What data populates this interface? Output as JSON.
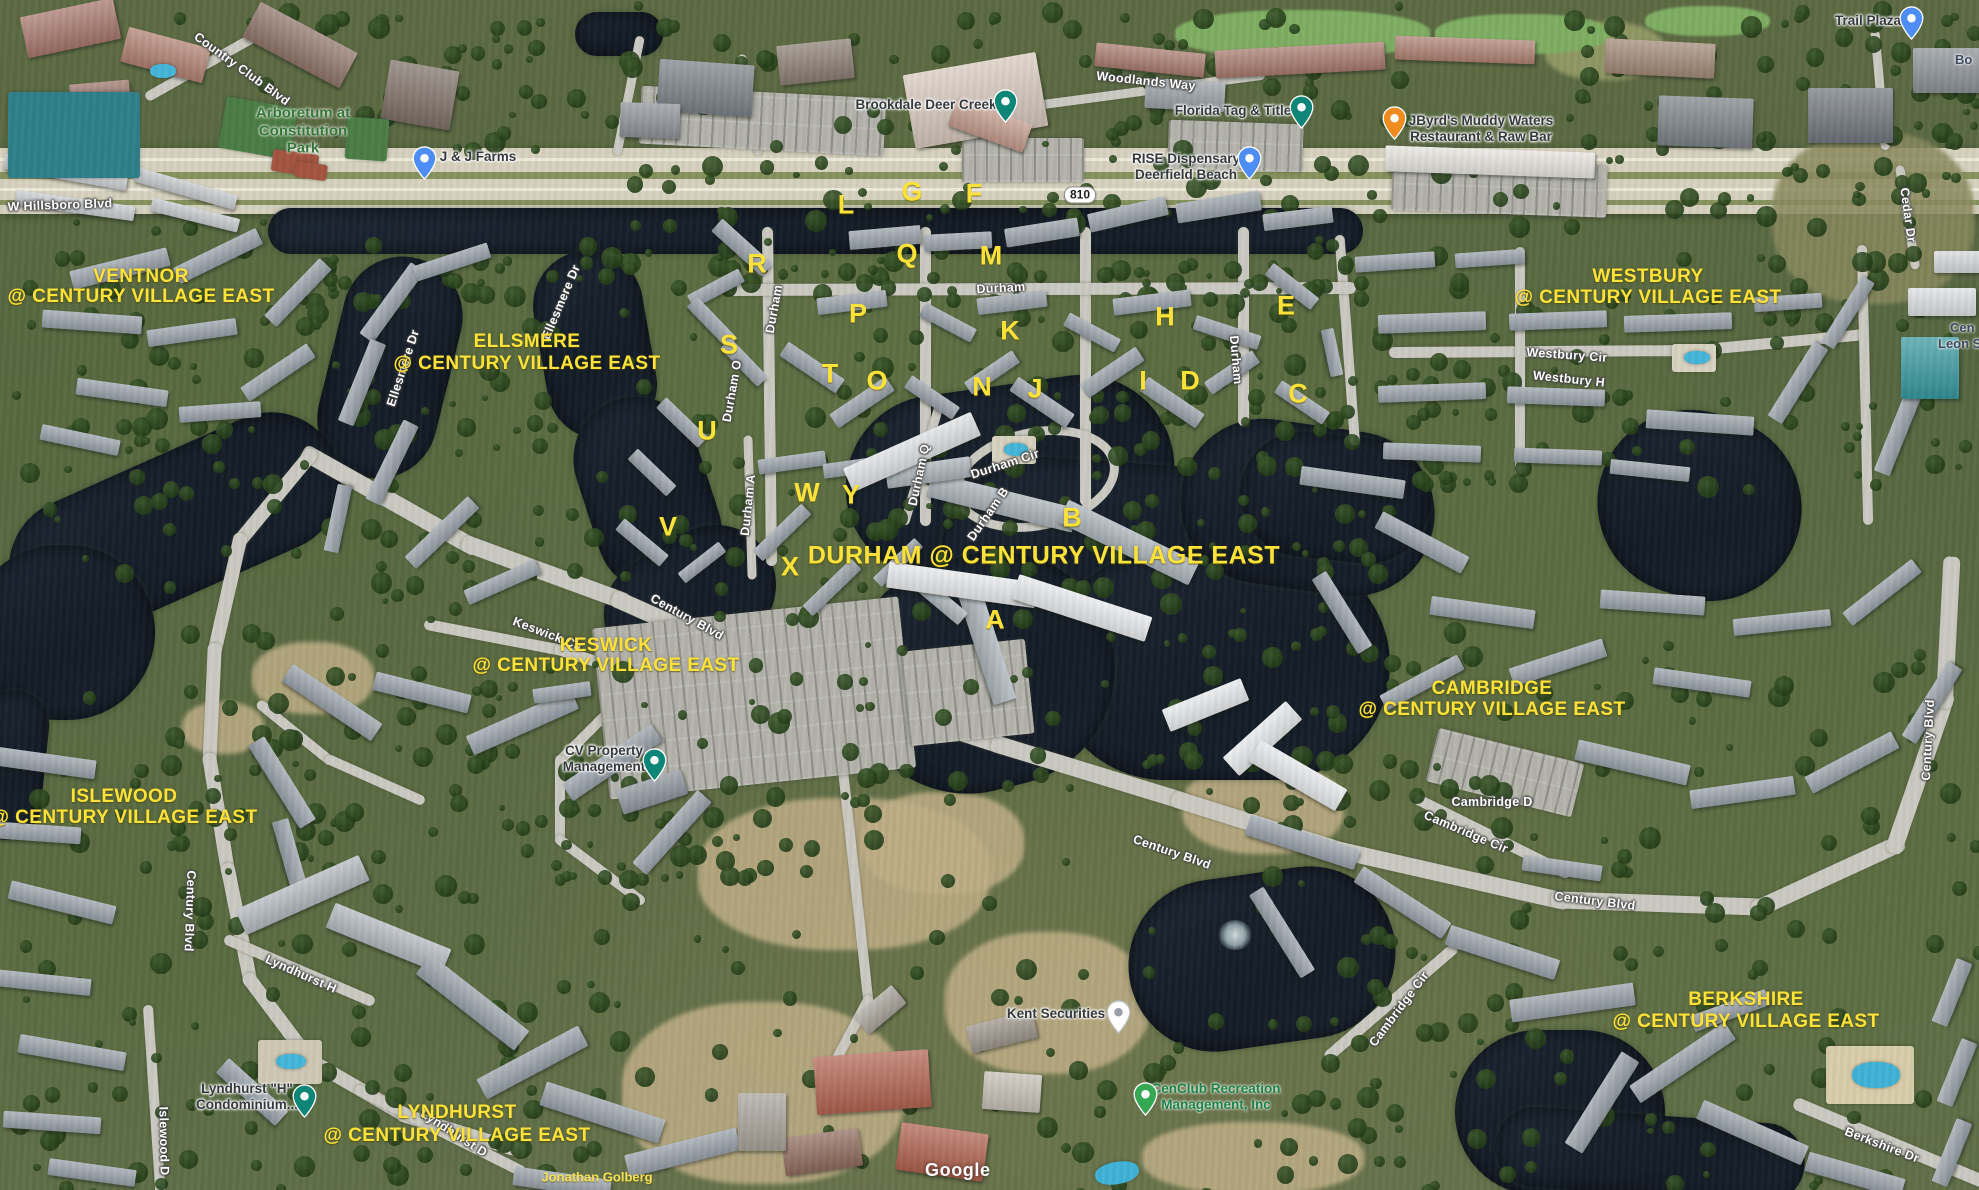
{
  "meta": {
    "app": "Google Maps satellite view",
    "area": "Century Village East, Deerfield Beach FL",
    "watermark": "Google"
  },
  "colors": {
    "overlay_yellow": "#fde23a",
    "road_label_white": "#ffffff",
    "poi_dark": "#35393d",
    "park_green": "#37773a",
    "rec_green": "#1b8246",
    "water": "#161e29",
    "pin_teal": "#0d8577",
    "pin_blue": "#4e8df5",
    "pin_orange": "#ef8b1f",
    "pin_green": "#34a853",
    "pin_white": "#ffffff"
  },
  "route_shield": {
    "text": "810",
    "x": 1080,
    "y": 195
  },
  "communities": [
    {
      "name": "VENTNOR",
      "tagline": "@ CENTURY VILLAGE EAST",
      "x": 141,
      "y": 277,
      "y2": 297,
      "big": false
    },
    {
      "name": "ELLSMERE",
      "tagline": "@ CENTURY VILLAGE EAST",
      "x": 527,
      "y": 342,
      "y2": 364,
      "big": false
    },
    {
      "name": "WESTBURY",
      "tagline": "@ CENTURY VILLAGE EAST",
      "x": 1648,
      "y": 277,
      "y2": 298,
      "big": false
    },
    {
      "name": "DURHAM @ CENTURY VILLAGE EAST",
      "tagline": "",
      "x": 1044,
      "y": 556,
      "y2": 0,
      "big": true
    },
    {
      "name": "KESWICK",
      "tagline": "@ CENTURY VILLAGE EAST",
      "x": 606,
      "y": 646,
      "y2": 666,
      "big": false
    },
    {
      "name": "ISLEWOOD",
      "tagline": "@ CENTURY VILLAGE EAST",
      "x": 124,
      "y": 797,
      "y2": 818,
      "big": false
    },
    {
      "name": "CAMBRIDGE",
      "tagline": "@ CENTURY VILLAGE EAST",
      "x": 1492,
      "y": 689,
      "y2": 710,
      "big": false
    },
    {
      "name": "BERKSHIRE",
      "tagline": "@ CENTURY VILLAGE EAST",
      "x": 1746,
      "y": 1000,
      "y2": 1022,
      "big": false
    },
    {
      "name": "LYNDHURST",
      "tagline": "@ CENTURY VILLAGE EAST",
      "x": 457,
      "y": 1113,
      "y2": 1136,
      "big": false
    }
  ],
  "building_letters": [
    {
      "t": "A",
      "x": 995,
      "y": 620
    },
    {
      "t": "B",
      "x": 1072,
      "y": 518
    },
    {
      "t": "C",
      "x": 1298,
      "y": 394
    },
    {
      "t": "D",
      "x": 1190,
      "y": 381
    },
    {
      "t": "E",
      "x": 1286,
      "y": 306
    },
    {
      "t": "F",
      "x": 974,
      "y": 194
    },
    {
      "t": "G",
      "x": 912,
      "y": 192
    },
    {
      "t": "H",
      "x": 1165,
      "y": 317
    },
    {
      "t": "I",
      "x": 1143,
      "y": 381
    },
    {
      "t": "J",
      "x": 1035,
      "y": 389
    },
    {
      "t": "K",
      "x": 1010,
      "y": 331
    },
    {
      "t": "L",
      "x": 846,
      "y": 205
    },
    {
      "t": "M",
      "x": 991,
      "y": 256
    },
    {
      "t": "N",
      "x": 982,
      "y": 387
    },
    {
      "t": "O",
      "x": 877,
      "y": 381
    },
    {
      "t": "P",
      "x": 858,
      "y": 314
    },
    {
      "t": "Q",
      "x": 907,
      "y": 254
    },
    {
      "t": "R",
      "x": 757,
      "y": 264
    },
    {
      "t": "S",
      "x": 729,
      "y": 345
    },
    {
      "t": "T",
      "x": 830,
      "y": 374
    },
    {
      "t": "U",
      "x": 707,
      "y": 431
    },
    {
      "t": "V",
      "x": 668,
      "y": 527
    },
    {
      "t": "W",
      "x": 807,
      "y": 493
    },
    {
      "t": "X",
      "x": 790,
      "y": 567
    },
    {
      "t": "Y",
      "x": 851,
      "y": 495
    }
  ],
  "road_labels": [
    {
      "t": "W Hillsboro Blvd",
      "x": 60,
      "y": 205,
      "r": -2
    },
    {
      "t": "Country Club Blvd",
      "x": 242,
      "y": 69,
      "r": 36
    },
    {
      "t": "Woodlands Way",
      "x": 1146,
      "y": 81,
      "r": 6
    },
    {
      "t": "Cedar Dr",
      "x": 1908,
      "y": 215,
      "r": 82
    },
    {
      "t": "Durham",
      "x": 1001,
      "y": 288,
      "r": -3
    },
    {
      "t": "Durham",
      "x": 774,
      "y": 309,
      "r": -80
    },
    {
      "t": "Durham",
      "x": 1236,
      "y": 360,
      "r": 85
    },
    {
      "t": "Durham A",
      "x": 748,
      "y": 505,
      "r": -84
    },
    {
      "t": "Durham O",
      "x": 732,
      "y": 391,
      "r": -80
    },
    {
      "t": "Durham Q",
      "x": 919,
      "y": 475,
      "r": -78
    },
    {
      "t": "Durham Cir",
      "x": 1005,
      "y": 464,
      "r": -18
    },
    {
      "t": "Durham B",
      "x": 988,
      "y": 514,
      "r": -55
    },
    {
      "t": "Ellesmere Dr",
      "x": 561,
      "y": 302,
      "r": -67
    },
    {
      "t": "Ellesmere Dr",
      "x": 403,
      "y": 368,
      "r": -72
    },
    {
      "t": "Century Blvd",
      "x": 687,
      "y": 617,
      "r": 29
    },
    {
      "t": "Keswick Cir",
      "x": 548,
      "y": 634,
      "r": 21
    },
    {
      "t": "Century Blvd",
      "x": 190,
      "y": 911,
      "r": 92
    },
    {
      "t": "Lyndhurst H",
      "x": 301,
      "y": 974,
      "r": 24
    },
    {
      "t": "Islewood D",
      "x": 164,
      "y": 1141,
      "r": 89
    },
    {
      "t": "Lyndhurst D",
      "x": 454,
      "y": 1133,
      "r": 33
    },
    {
      "t": "Century Blvd",
      "x": 1172,
      "y": 852,
      "r": 19
    },
    {
      "t": "Century Blvd",
      "x": 1595,
      "y": 901,
      "r": 7
    },
    {
      "t": "Cambridge Cir",
      "x": 1466,
      "y": 832,
      "r": 23
    },
    {
      "t": "Cambridge Cir",
      "x": 1399,
      "y": 1009,
      "r": -53
    },
    {
      "t": "Cambridge D",
      "x": 1492,
      "y": 802,
      "r": 0
    },
    {
      "t": "Westbury Cir",
      "x": 1567,
      "y": 355,
      "r": 4
    },
    {
      "t": "Westbury H",
      "x": 1569,
      "y": 379,
      "r": 6
    },
    {
      "t": "Berkshire Dr",
      "x": 1882,
      "y": 1145,
      "r": 21
    },
    {
      "t": "Century Blvd",
      "x": 1928,
      "y": 740,
      "r": -87
    }
  ],
  "pois": [
    {
      "lines": [
        "Brookdale Deer Creek"
      ],
      "x": 926,
      "y": 105,
      "style": "poi-dark",
      "pin": {
        "icon": "health-pin-icon",
        "color": "#0d8577",
        "x": 993,
        "y": 89
      }
    },
    {
      "lines": [
        "Florida Tag & Title"
      ],
      "x": 1233,
      "y": 111,
      "style": "poi-dark",
      "pin": {
        "icon": "bank-pin-icon",
        "color": "#0d8577",
        "x": 1289,
        "y": 95
      }
    },
    {
      "lines": [
        "RISE Dispensary",
        "Deerfield Beach"
      ],
      "x": 1186,
      "y": 167,
      "style": "poi-dark",
      "pin": {
        "icon": "shopping-bag-pin-icon",
        "color": "#4e8df5",
        "x": 1237,
        "y": 146
      }
    },
    {
      "lines": [
        "JByrd's Muddy Waters",
        "Restaurant & Raw Bar"
      ],
      "x": 1481,
      "y": 129,
      "style": "poi-dark",
      "pin": {
        "icon": "restaurant-pin-icon",
        "color": "#ef8b1f",
        "x": 1382,
        "y": 106
      }
    },
    {
      "lines": [
        "Trail Plaza"
      ],
      "x": 1868,
      "y": 21,
      "style": "poi-dark",
      "pin": {
        "icon": "shopping-bag-pin-icon",
        "color": "#4e8df5",
        "x": 1899,
        "y": 6
      }
    },
    {
      "lines": [
        "J & J Farms"
      ],
      "x": 478,
      "y": 157,
      "style": "poi-dark",
      "pin": {
        "icon": "grocery-cart-pin-icon",
        "color": "#4e8df5",
        "x": 412,
        "y": 146
      }
    },
    {
      "lines": [
        "Arboretum at",
        "Constitution",
        "Park"
      ],
      "x": 303,
      "y": 131,
      "style": "poi-park",
      "pin": null
    },
    {
      "lines": [
        "CV Property",
        "Management"
      ],
      "x": 604,
      "y": 759,
      "style": "poi-dark",
      "pin": {
        "icon": "place-pin-icon",
        "color": "#0d8577",
        "x": 642,
        "y": 748
      }
    },
    {
      "lines": [
        "Kent Securities"
      ],
      "x": 1056,
      "y": 1014,
      "style": "poi-dark",
      "pin": {
        "icon": "business-pin-icon",
        "color": "#ffffff",
        "x": 1106,
        "y": 1000
      }
    },
    {
      "lines": [
        "CenClub Recreation",
        "Management, Inc"
      ],
      "x": 1216,
      "y": 1097,
      "style": "poi-rec",
      "pin": {
        "icon": "recreation-pin-icon",
        "color": "#34a853",
        "x": 1133,
        "y": 1082
      }
    },
    {
      "lines": [
        "Lyndhurst \"H\"",
        "Condominium..."
      ],
      "x": 247,
      "y": 1097,
      "style": "poi-dark",
      "pin": {
        "icon": "place-pin-icon",
        "color": "#0d8577",
        "x": 292,
        "y": 1084
      }
    },
    {
      "lines": [
        "Jonathan Golberg"
      ],
      "x": 597,
      "y": 1177,
      "style": "poi-ysm",
      "pin": null
    }
  ],
  "edge_labels": [
    {
      "t": "Bo",
      "x": 1955,
      "y": 52
    },
    {
      "t": "Cen",
      "x": 1950,
      "y": 320
    },
    {
      "t": "Leon Sla",
      "x": 1938,
      "y": 336
    }
  ]
}
